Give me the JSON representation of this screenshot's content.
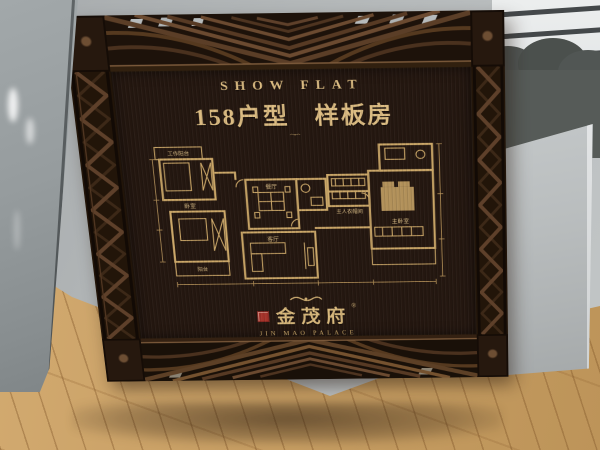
{
  "sign": {
    "header": {
      "en": "SHOW FLAT",
      "type_label": "158户型",
      "room_label": "样板房"
    },
    "brand": {
      "cn": "金茂府",
      "reg": "®",
      "en": "JIN MAO PALACE"
    },
    "floorplan_labels": {
      "work_balcony": "工作阳台",
      "bedroom": "卧室",
      "dining": "餐厅",
      "living": "客厅",
      "closet": "主人衣帽间",
      "master": "主卧室",
      "balcony": "阳台"
    }
  },
  "colors": {
    "gold": "#d8b87c",
    "plate_bronze": "#64513f",
    "frame_wood": "#2b1b10",
    "seal_red": "#a5332a",
    "wall_gray": "#b4b8b9",
    "floor_wood": "#c89f64"
  }
}
